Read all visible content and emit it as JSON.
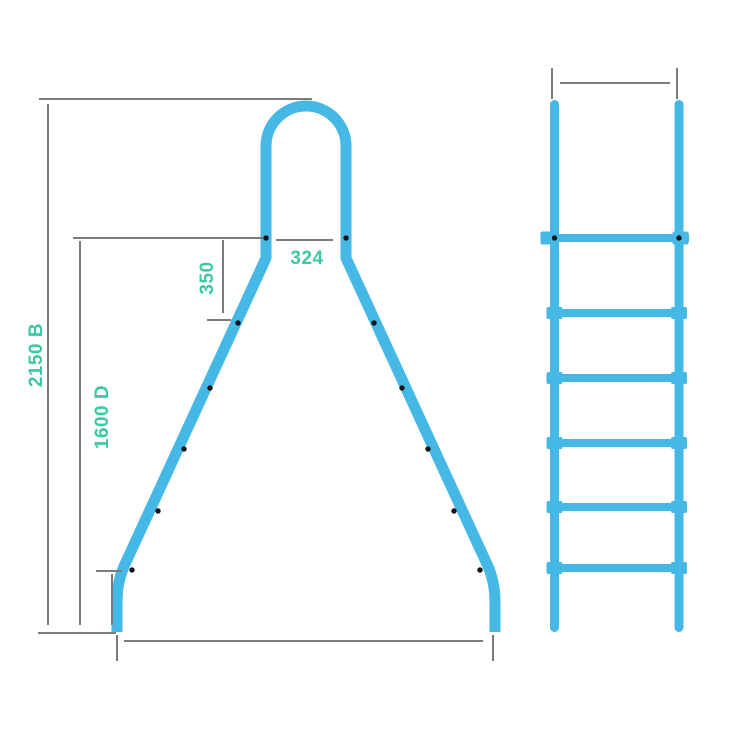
{
  "diagram": {
    "type": "technical-drawing",
    "subject": "pool ladder dimension diagram",
    "colors": {
      "ladder": "#45b8e6",
      "dimension_lines": "#7b7b7b",
      "labels": "#3cc7a5",
      "markers": "#151515"
    },
    "views": {
      "front": {
        "name": "front view",
        "labels": {
          "overall_height": "2150 B",
          "leg_section_height": "1600 D",
          "top_step_offset": "350",
          "top_width": "324"
        },
        "step_markers_per_leg": 6
      },
      "side": {
        "name": "side view",
        "rung_count": 6
      }
    }
  }
}
